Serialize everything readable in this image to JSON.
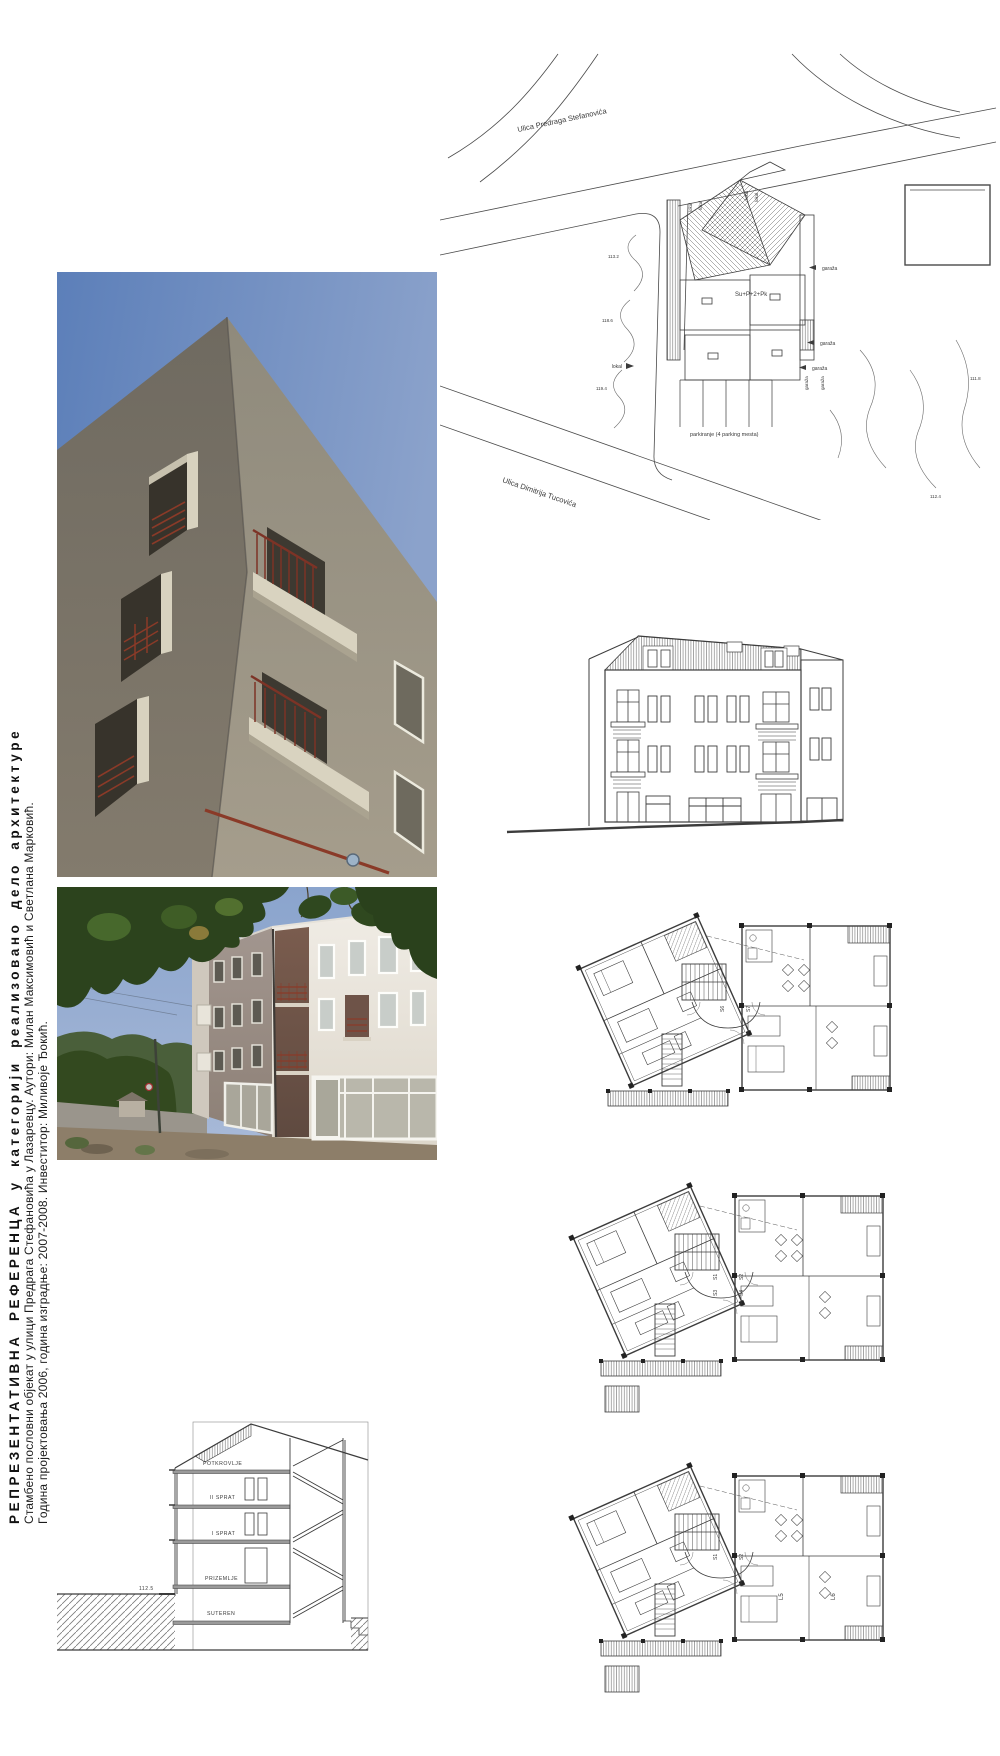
{
  "caption": {
    "title": "РЕПРЕЗЕНТАТИВНА РЕФЕРЕНЦА у категорији реализовано дело архитектуре",
    "line2": "Стамбено пословни објекат у улици Предрага Стефановића у Лазаревцу. Аутори: Милан Максимовић и Светлана Марковић.",
    "line3": "Година пројектовања 2006, година изградње: 2007-2008. Инвеститор: Миливоје Ђокић."
  },
  "site_plan": {
    "street_top": "Ulica Predraga Stefanovića",
    "street_bottom": "Ulica Dimitrija Tucovića",
    "building_label": "Su+P+2+Pk",
    "parking_label": "parkiranje (4 parking mesta)",
    "lokal_label": "lokal",
    "garaza_label": "garaža",
    "contours": [
      "113.2",
      "118.6",
      "119.4",
      "111.8",
      "112.4"
    ]
  },
  "floor_plans": {
    "plan1": {
      "labels": [
        "S6",
        "S7"
      ]
    },
    "plan2": {
      "labels": [
        "S1",
        "S2",
        "S3",
        "S4"
      ]
    },
    "plan3": {
      "labels": [
        "S1",
        "S2",
        "L5",
        "L6"
      ]
    }
  },
  "section": {
    "floor_labels": [
      "POTKROVLJE",
      "II SPRAT",
      "I SPRAT",
      "PRIZEMLJE",
      "SUTEREN"
    ],
    "level_mark": "112.5"
  },
  "colors": {
    "sky": "#7d98c6",
    "facade_dark": "#746e63",
    "facade_light": "#e9e6df",
    "facade_pink": "#9a8e89",
    "balcony_cream": "#d9d3c0",
    "railing_red": "#8a3a28",
    "foliage": "#2f481f",
    "drawing_line": "#3c3c3c"
  }
}
